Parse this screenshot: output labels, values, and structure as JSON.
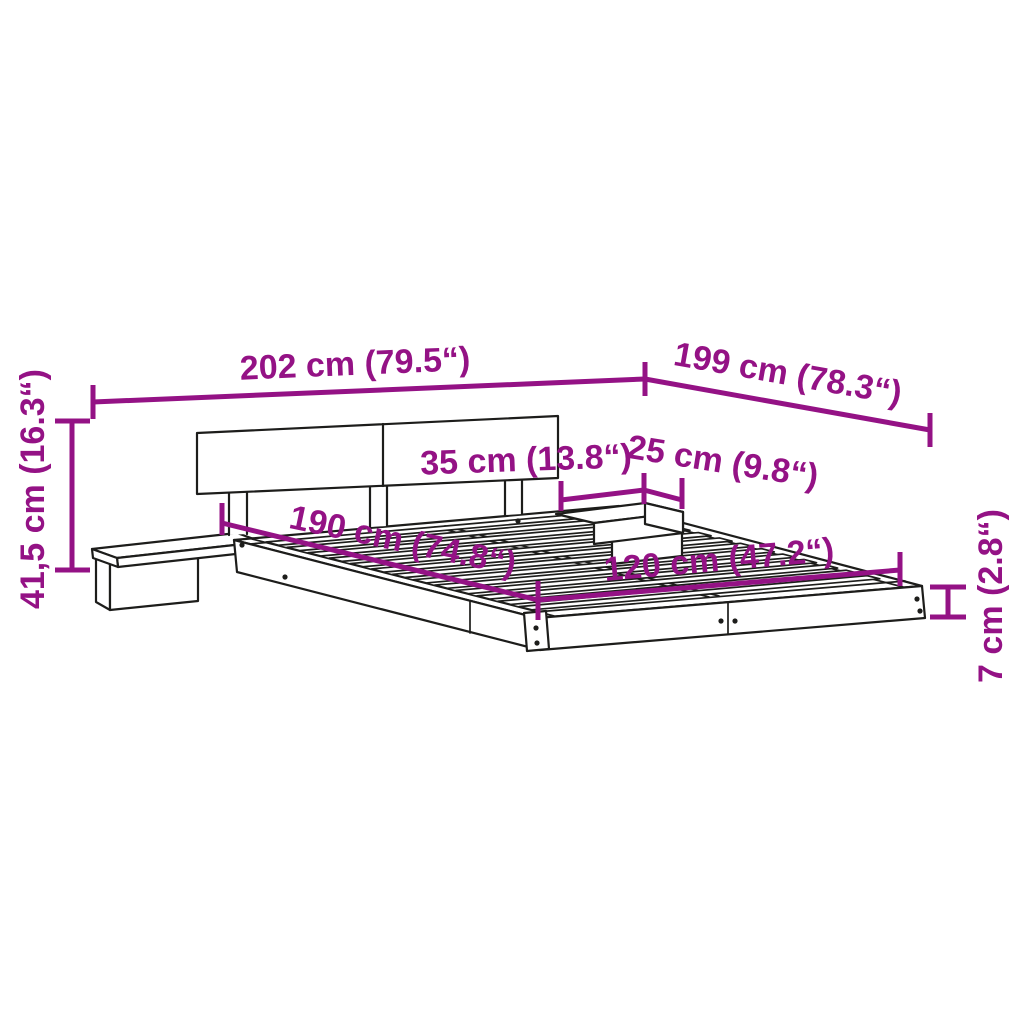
{
  "colors": {
    "dim-color": "#941285",
    "ink": "#1d1d1b",
    "paper": "#ffffff"
  },
  "dims": [
    {
      "name": "overall-width",
      "label": "202 cm (79.5“)"
    },
    {
      "name": "overall-depth",
      "label": "199 cm (78.3“)"
    },
    {
      "name": "overall-height",
      "label": "41,5 cm (16.3“)"
    },
    {
      "name": "nightstand-width",
      "label": "35 cm (13.8“)"
    },
    {
      "name": "nightstand-depth",
      "label": "25 cm (9.8“)"
    },
    {
      "name": "sleeping-length",
      "label": "190 cm (74.8“)"
    },
    {
      "name": "sleeping-width",
      "label": "120 cm (47.2“)"
    },
    {
      "name": "frame-height",
      "label": "7 cm (2.8“)"
    }
  ]
}
